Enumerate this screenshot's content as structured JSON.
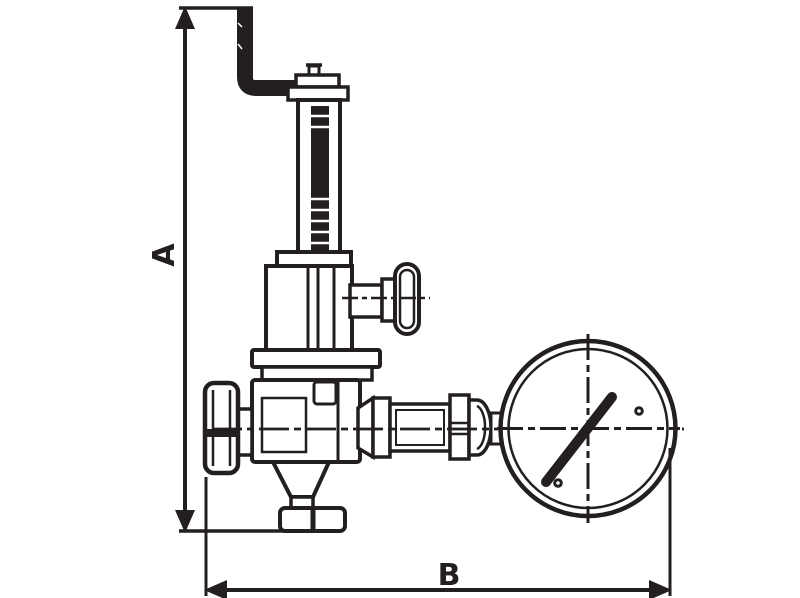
{
  "meta": {
    "background": "#ffffff",
    "ink": "#231f20"
  },
  "labels": {
    "dim_a": "A",
    "dim_b": "B"
  },
  "drawing": {
    "kind": "technical dimensional line drawing",
    "subject": "spring-loaded pressure reducing valve with vent pipe, side handle and pressure gauge",
    "dimension_lines": [
      {
        "label": "A",
        "orientation": "vertical",
        "measures": "overall height from valve bottom union to top of vent pipe"
      },
      {
        "label": "B",
        "orientation": "horizontal",
        "measures": "overall width from inlet plug to outer edge of gauge"
      }
    ],
    "components": [
      "vent-pipe-elbow",
      "adjusting-cap",
      "bonnet-tube-with-thread-marks",
      "spring-housing",
      "side-valve-handle",
      "valve-body",
      "inlet-plug",
      "bottom-outlet-union",
      "gauge-connection-piping",
      "hex-nut",
      "pressure-gauge-with-needle"
    ]
  }
}
